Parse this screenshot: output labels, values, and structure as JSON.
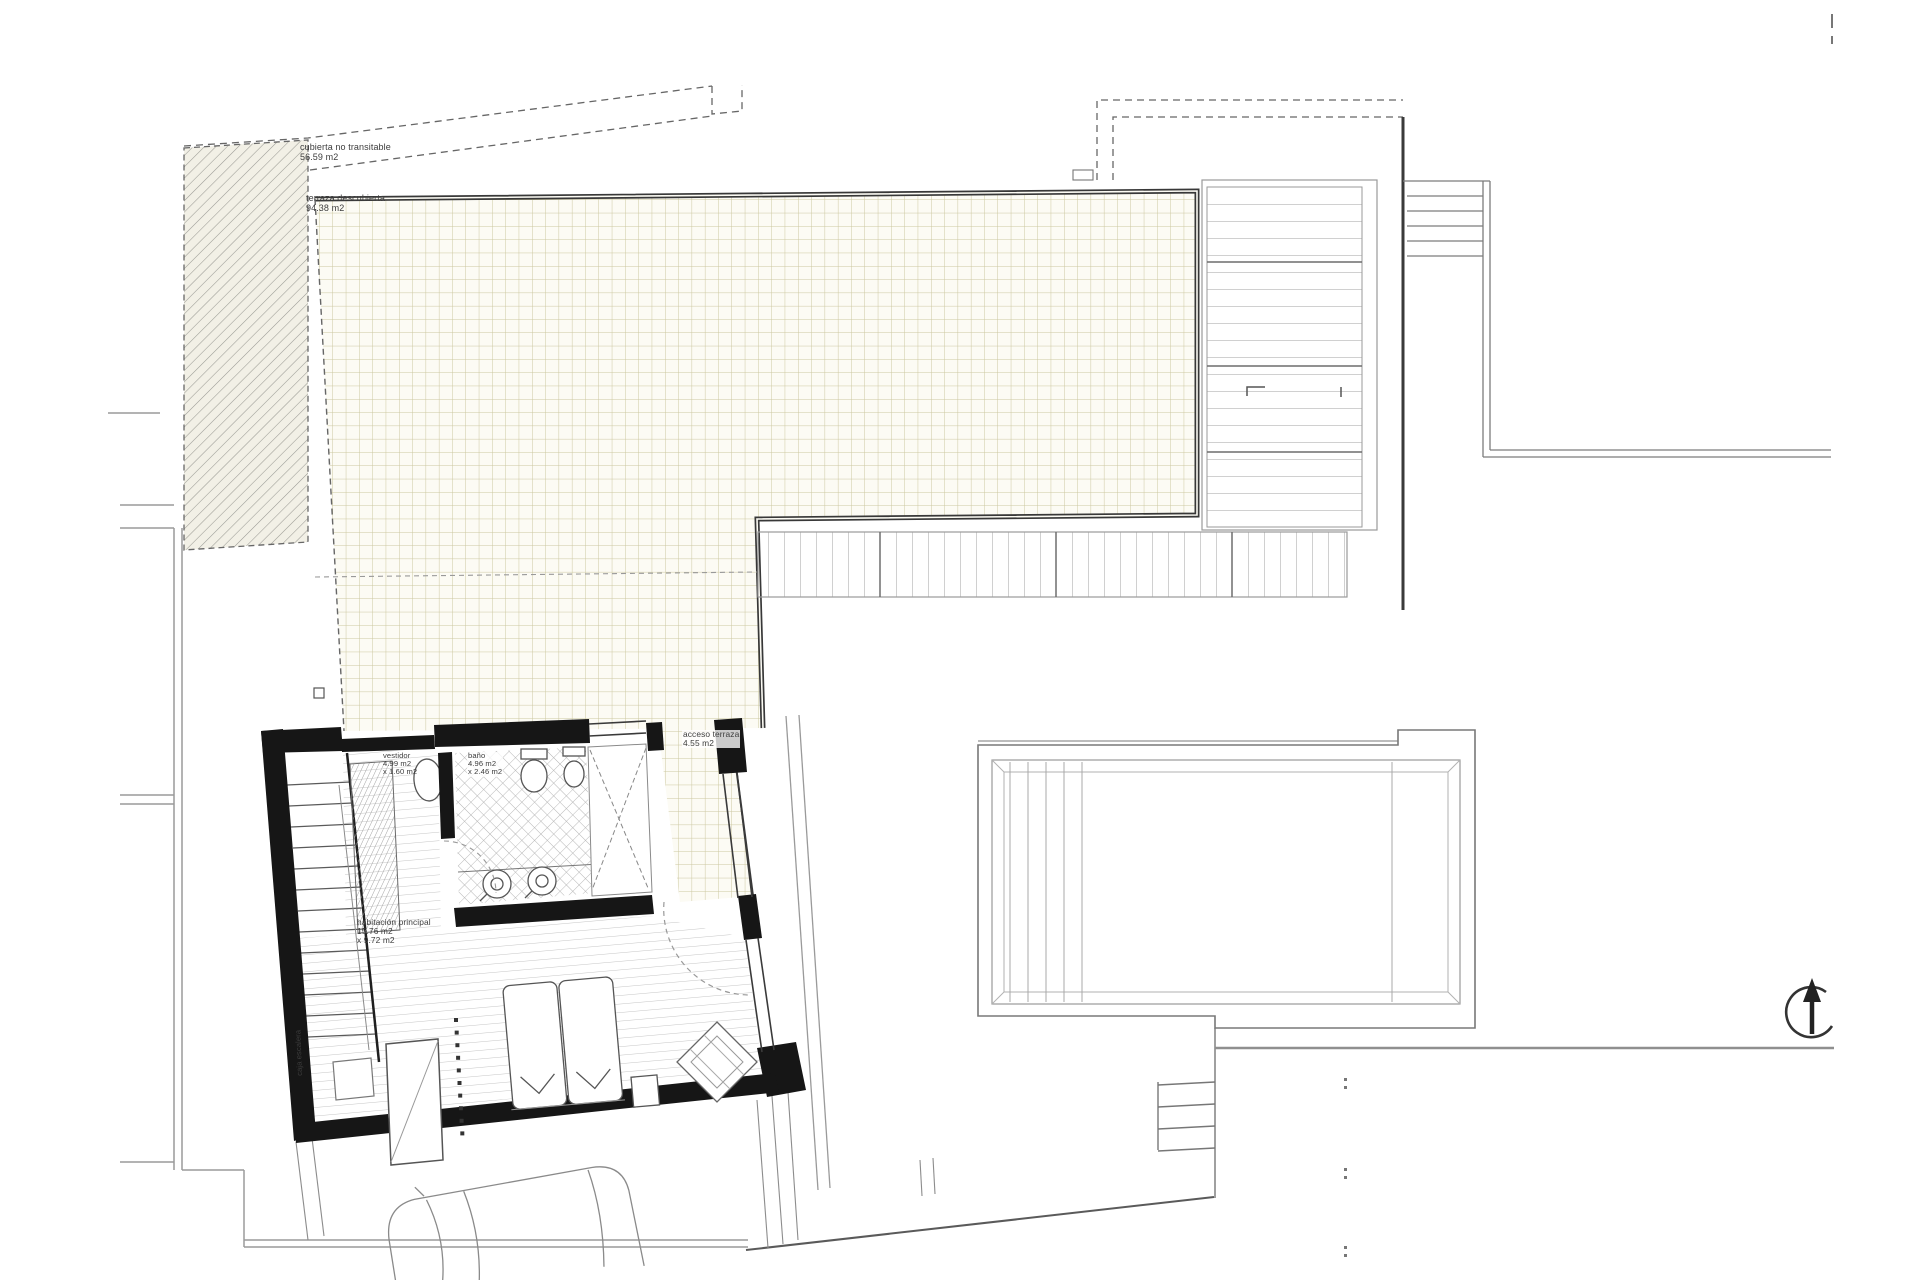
{
  "page": {
    "kind": "architectural floor plan (upper floor / roof plan)",
    "background": "#ffffff"
  },
  "colors": {
    "wall_black": "#161616",
    "border_dark": "#3a3a3a",
    "line_mid": "#8c8c8c",
    "line_light": "#b5b5b5",
    "tile_grid": "#ccc7a0",
    "paper_tint": "#fcfbf4",
    "hatch_bg": "#f2f0e6"
  },
  "labels": {
    "roof": {
      "line1": "cubierta no transitable",
      "line2": "56.59 m2"
    },
    "terrace": {
      "line1": "terraza descubierta",
      "line2": "94.38 m2"
    },
    "terrace_access": {
      "line1": "acceso terraza",
      "line2": "4.55 m2"
    },
    "dressing": {
      "line1": "vestidor",
      "line2": "4.99 m2",
      "line3": "x 1.60 m2"
    },
    "bathroom": {
      "line1": "baño",
      "line2": "4.96 m2",
      "line3": "x 2.46 m2"
    },
    "master_bedroom": {
      "line1": "habitación principal",
      "line2": "15.76 m2",
      "line3": "x 9.72 m2"
    },
    "stair_shaft": {
      "line1": "caja escalera"
    }
  },
  "compass": {
    "name": "north-arrow"
  }
}
